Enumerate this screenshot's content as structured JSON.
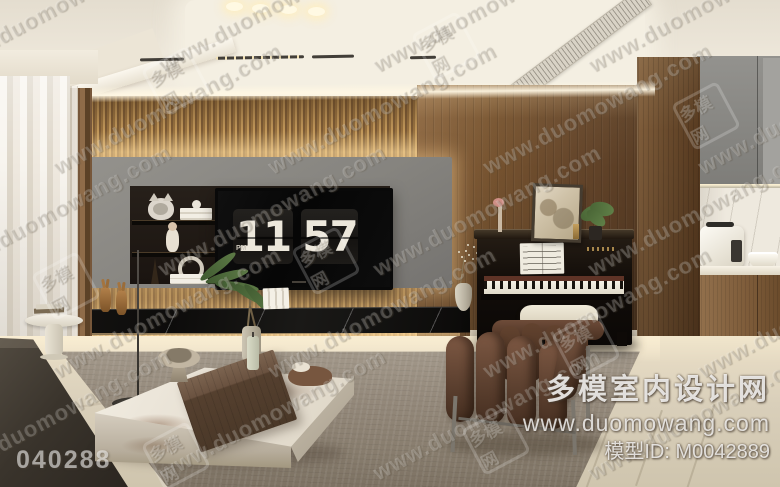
{
  "tv_clock": {
    "hours": "11",
    "minutes": "57",
    "meridiem": "PM"
  },
  "watermark": {
    "tile_text": "www.duomowang.com",
    "seal_text": "多模网"
  },
  "branding": {
    "site_name": "多模室内设计网",
    "site_url": "www.duomowang.com",
    "model_id_line": "模型ID: M0042889",
    "image_code": "040288"
  },
  "palette": {
    "cove_light": "#f7ead0",
    "slat_wood": "#9a7648",
    "plank_wood": "#6d4e31",
    "panel_gray": "#8f8d88",
    "console_marble": "#141312",
    "rug": "#8d8275",
    "floor": "#d8cebb",
    "chair_brown": "#5d4030",
    "piano_black": "#16110d"
  }
}
